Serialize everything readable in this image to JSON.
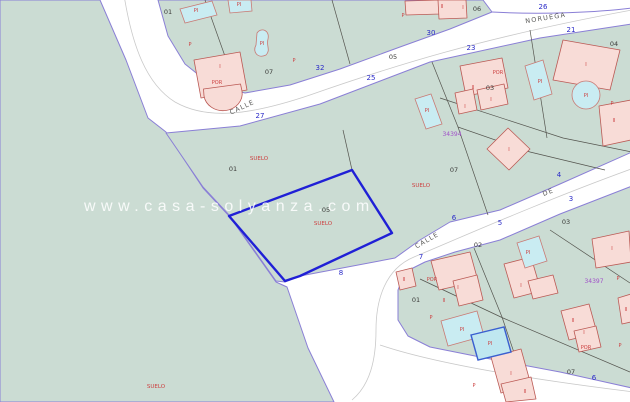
{
  "watermark": {
    "text": "www.casa-solyanza.com"
  },
  "selected_parcel": {
    "parcel_number": "05",
    "land_label": "SUELO",
    "color": "#2020d6"
  },
  "colors": {
    "parcel_green": "#cbdcd3",
    "building_fill": "#f8dcd7",
    "building_border": "#bb5a55",
    "pool_fill": "#c9ecf2",
    "highlight_pool_border": "#3a5fd0",
    "selected_parcel_blue": "#2020d6",
    "block_border_purple": "#8a7fd6",
    "street_number_blue": "#2a2ac8",
    "label_red": "#cc4040",
    "sheet_ref_purple": "#a050c8"
  },
  "map": {
    "street_names": [
      {
        "name": "street-name-calle-upper",
        "text": "CALLE",
        "x": 243,
        "y": 109,
        "rotate": -25
      },
      {
        "name": "street-name-noruega",
        "text": "NORUEGA",
        "x": 546,
        "y": 20,
        "rotate": -9
      },
      {
        "name": "street-name-calle-lower",
        "text": "CALLE",
        "x": 428,
        "y": 242,
        "rotate": -30
      },
      {
        "name": "street-name-de",
        "text": "DE",
        "x": 549,
        "y": 194,
        "rotate": -22
      }
    ],
    "street_numbers": [
      {
        "name": "street-number-27",
        "text": "27",
        "x": 260,
        "y": 118
      },
      {
        "name": "street-number-32",
        "text": "32",
        "x": 320,
        "y": 70
      },
      {
        "name": "street-number-25",
        "text": "25",
        "x": 371,
        "y": 80
      },
      {
        "name": "street-number-30",
        "text": "30",
        "x": 431,
        "y": 35
      },
      {
        "name": "street-number-23",
        "text": "23",
        "x": 471,
        "y": 50
      },
      {
        "name": "street-number-26",
        "text": "26",
        "x": 543,
        "y": 9
      },
      {
        "name": "street-number-21",
        "text": "21",
        "x": 571,
        "y": 32
      },
      {
        "name": "street-number-4",
        "text": "4",
        "x": 559,
        "y": 177
      },
      {
        "name": "street-number-3",
        "text": "3",
        "x": 571,
        "y": 201
      },
      {
        "name": "street-number-6",
        "text": "6",
        "x": 454,
        "y": 220
      },
      {
        "name": "street-number-5",
        "text": "5",
        "x": 500,
        "y": 225
      },
      {
        "name": "street-number-7",
        "text": "7",
        "x": 421,
        "y": 259
      },
      {
        "name": "street-number-8",
        "text": "8",
        "x": 341,
        "y": 275
      },
      {
        "name": "street-number-6b",
        "text": "6",
        "x": 594,
        "y": 380
      }
    ],
    "parcel_numbers": [
      {
        "name": "parcel-number-01-top",
        "text": "01",
        "x": 168,
        "y": 14
      },
      {
        "name": "parcel-number-07-top",
        "text": "07",
        "x": 269,
        "y": 74
      },
      {
        "name": "parcel-number-05-top",
        "text": "05",
        "x": 393,
        "y": 59
      },
      {
        "name": "parcel-number-06-top",
        "text": "06",
        "x": 477,
        "y": 11
      },
      {
        "name": "parcel-number-04",
        "text": "04",
        "x": 614,
        "y": 46
      },
      {
        "name": "parcel-number-03-mid",
        "text": "03",
        "x": 490,
        "y": 90
      },
      {
        "name": "parcel-number-01-mid",
        "text": "01",
        "x": 233,
        "y": 171
      },
      {
        "name": "parcel-number-05-selected",
        "text": "05",
        "x": 326,
        "y": 212
      },
      {
        "name": "parcel-number-07-mid",
        "text": "07",
        "x": 454,
        "y": 172
      },
      {
        "name": "parcel-number-02-bottom",
        "text": "02",
        "x": 478,
        "y": 247
      },
      {
        "name": "parcel-number-03-bottom",
        "text": "03",
        "x": 566,
        "y": 224
      },
      {
        "name": "parcel-number-01-bottom",
        "text": "01",
        "x": 416,
        "y": 302
      },
      {
        "name": "parcel-number-07-bottom",
        "text": "07",
        "x": 571,
        "y": 374
      }
    ],
    "land_labels": [
      {
        "name": "land-label-suelo-1",
        "text": "SUELO",
        "x": 259,
        "y": 160
      },
      {
        "name": "land-label-suelo-selected",
        "text": "SUELO",
        "x": 323,
        "y": 225
      },
      {
        "name": "land-label-suelo-2",
        "text": "SUELO",
        "x": 421,
        "y": 187
      },
      {
        "name": "land-label-suelo-3",
        "text": "SUELO",
        "x": 156,
        "y": 388
      }
    ],
    "building_labels": [
      {
        "name": "pool-label-pi",
        "text": "PI",
        "x": 196,
        "y": 12
      },
      {
        "name": "pool-label-pi",
        "text": "PI",
        "x": 239,
        "y": 6
      },
      {
        "name": "pool-label-pi",
        "text": "PI",
        "x": 262,
        "y": 45
      },
      {
        "name": "pool-label-pi",
        "text": "PI",
        "x": 427,
        "y": 112
      },
      {
        "name": "pool-label-pi",
        "text": "PI",
        "x": 540,
        "y": 83
      },
      {
        "name": "pool-label-pi",
        "text": "PI",
        "x": 586,
        "y": 97
      },
      {
        "name": "pool-label-pi",
        "text": "PI",
        "x": 528,
        "y": 254
      },
      {
        "name": "pool-label-pi",
        "text": "PI",
        "x": 462,
        "y": 331
      },
      {
        "name": "pool-label-pi",
        "text": "PI",
        "x": 490,
        "y": 345
      },
      {
        "name": "floor-label-i",
        "text": "I",
        "x": 220,
        "y": 68
      },
      {
        "name": "floor-label-i",
        "text": "I",
        "x": 463,
        "y": 9
      },
      {
        "name": "floor-label-i",
        "text": "I",
        "x": 465,
        "y": 108
      },
      {
        "name": "floor-label-i",
        "text": "I",
        "x": 491,
        "y": 101
      },
      {
        "name": "floor-label-i",
        "text": "I",
        "x": 586,
        "y": 66
      },
      {
        "name": "floor-label-i",
        "text": "I",
        "x": 509,
        "y": 151
      },
      {
        "name": "floor-label-i",
        "text": "I",
        "x": 521,
        "y": 287
      },
      {
        "name": "floor-label-i",
        "text": "I",
        "x": 612,
        "y": 250
      },
      {
        "name": "floor-label-i",
        "text": "I",
        "x": 458,
        "y": 289
      },
      {
        "name": "floor-label-i",
        "text": "I",
        "x": 511,
        "y": 375
      },
      {
        "name": "floor-label-i",
        "text": "I",
        "x": 584,
        "y": 334
      },
      {
        "name": "floor-label-ii",
        "text": "II",
        "x": 442,
        "y": 8
      },
      {
        "name": "floor-label-ii",
        "text": "II",
        "x": 473,
        "y": 89
      },
      {
        "name": "floor-label-ii",
        "text": "II",
        "x": 614,
        "y": 122
      },
      {
        "name": "floor-label-ii",
        "text": "II",
        "x": 404,
        "y": 281
      },
      {
        "name": "floor-label-ii",
        "text": "II",
        "x": 444,
        "y": 302
      },
      {
        "name": "floor-label-ii",
        "text": "II",
        "x": 525,
        "y": 393
      },
      {
        "name": "floor-label-ii",
        "text": "II",
        "x": 573,
        "y": 322
      },
      {
        "name": "floor-label-ii",
        "text": "II",
        "x": 626,
        "y": 311
      },
      {
        "name": "porch-label-por",
        "text": "POR",
        "x": 217,
        "y": 84
      },
      {
        "name": "porch-label-por",
        "text": "POR",
        "x": 498,
        "y": 74
      },
      {
        "name": "porch-label-por",
        "text": "POR",
        "x": 432,
        "y": 281
      },
      {
        "name": "porch-label-por",
        "text": "POR",
        "x": 586,
        "y": 349
      },
      {
        "name": "plot-label-p",
        "text": "P",
        "x": 190,
        "y": 46
      },
      {
        "name": "plot-label-p",
        "text": "P",
        "x": 294,
        "y": 62
      },
      {
        "name": "plot-label-p",
        "text": "P",
        "x": 403,
        "y": 17
      },
      {
        "name": "plot-label-p",
        "text": "P",
        "x": 612,
        "y": 105
      },
      {
        "name": "plot-label-p",
        "text": "P",
        "x": 618,
        "y": 280
      },
      {
        "name": "plot-label-p",
        "text": "P",
        "x": 431,
        "y": 319
      },
      {
        "name": "plot-label-p",
        "text": "P",
        "x": 474,
        "y": 387
      },
      {
        "name": "plot-label-p",
        "text": "P",
        "x": 620,
        "y": 347
      }
    ],
    "sheet_refs": [
      {
        "name": "sheet-ref-34394",
        "text": "34394",
        "x": 452,
        "y": 136
      },
      {
        "name": "sheet-ref-34397",
        "text": "34397",
        "x": 594,
        "y": 283
      }
    ]
  }
}
